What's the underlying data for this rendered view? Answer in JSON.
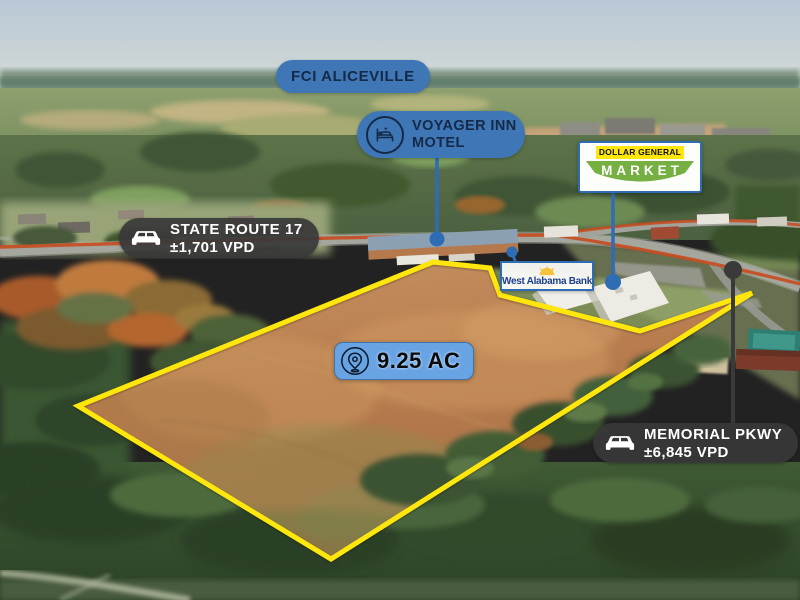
{
  "colors": {
    "boundary_yellow": "#ffe60d",
    "road_highlight_orange": "#c84b1e",
    "badge_blue": "#3f76b6",
    "badge_blue_light": "#68a3e4",
    "badge_navy_text": "#152a47",
    "badge_dark": "#383838",
    "stem_blue": "#2e6cb4",
    "stem_dark": "#3a3a3a",
    "dg_yellow": "#ffe60d",
    "dg_green": "#76b043",
    "dg_border_blue": "#2e6cb4",
    "bank_text_blue": "#1c3f8e",
    "bank_sun_yellow": "#f6c33c"
  },
  "labels": {
    "fci": {
      "text": "FCI ALICEVILLE"
    },
    "voyager_inn": {
      "line1": "VOYAGER INN",
      "line2": "MOTEL"
    },
    "dollar_general": {
      "line1": "DOLLAR GENERAL",
      "line2": "MARKET",
      "trademark": "™"
    },
    "west_alabama_bank": {
      "text": "West Alabama Bank"
    },
    "state_route_17": {
      "road": "STATE ROUTE 17",
      "traffic": "±1,701 VPD"
    },
    "memorial_pkwy": {
      "road": "MEMORIAL PKWY",
      "traffic": "±6,845 VPD"
    },
    "parcel": {
      "acreage": "9.25 AC"
    }
  },
  "icons": {
    "voyager_inn": "bed-motel-icon",
    "state_route_17": "car-icon",
    "memorial_pkwy": "car-icon",
    "parcel": "location-pin-icon",
    "west_alabama_bank": "sun-logo-icon"
  }
}
